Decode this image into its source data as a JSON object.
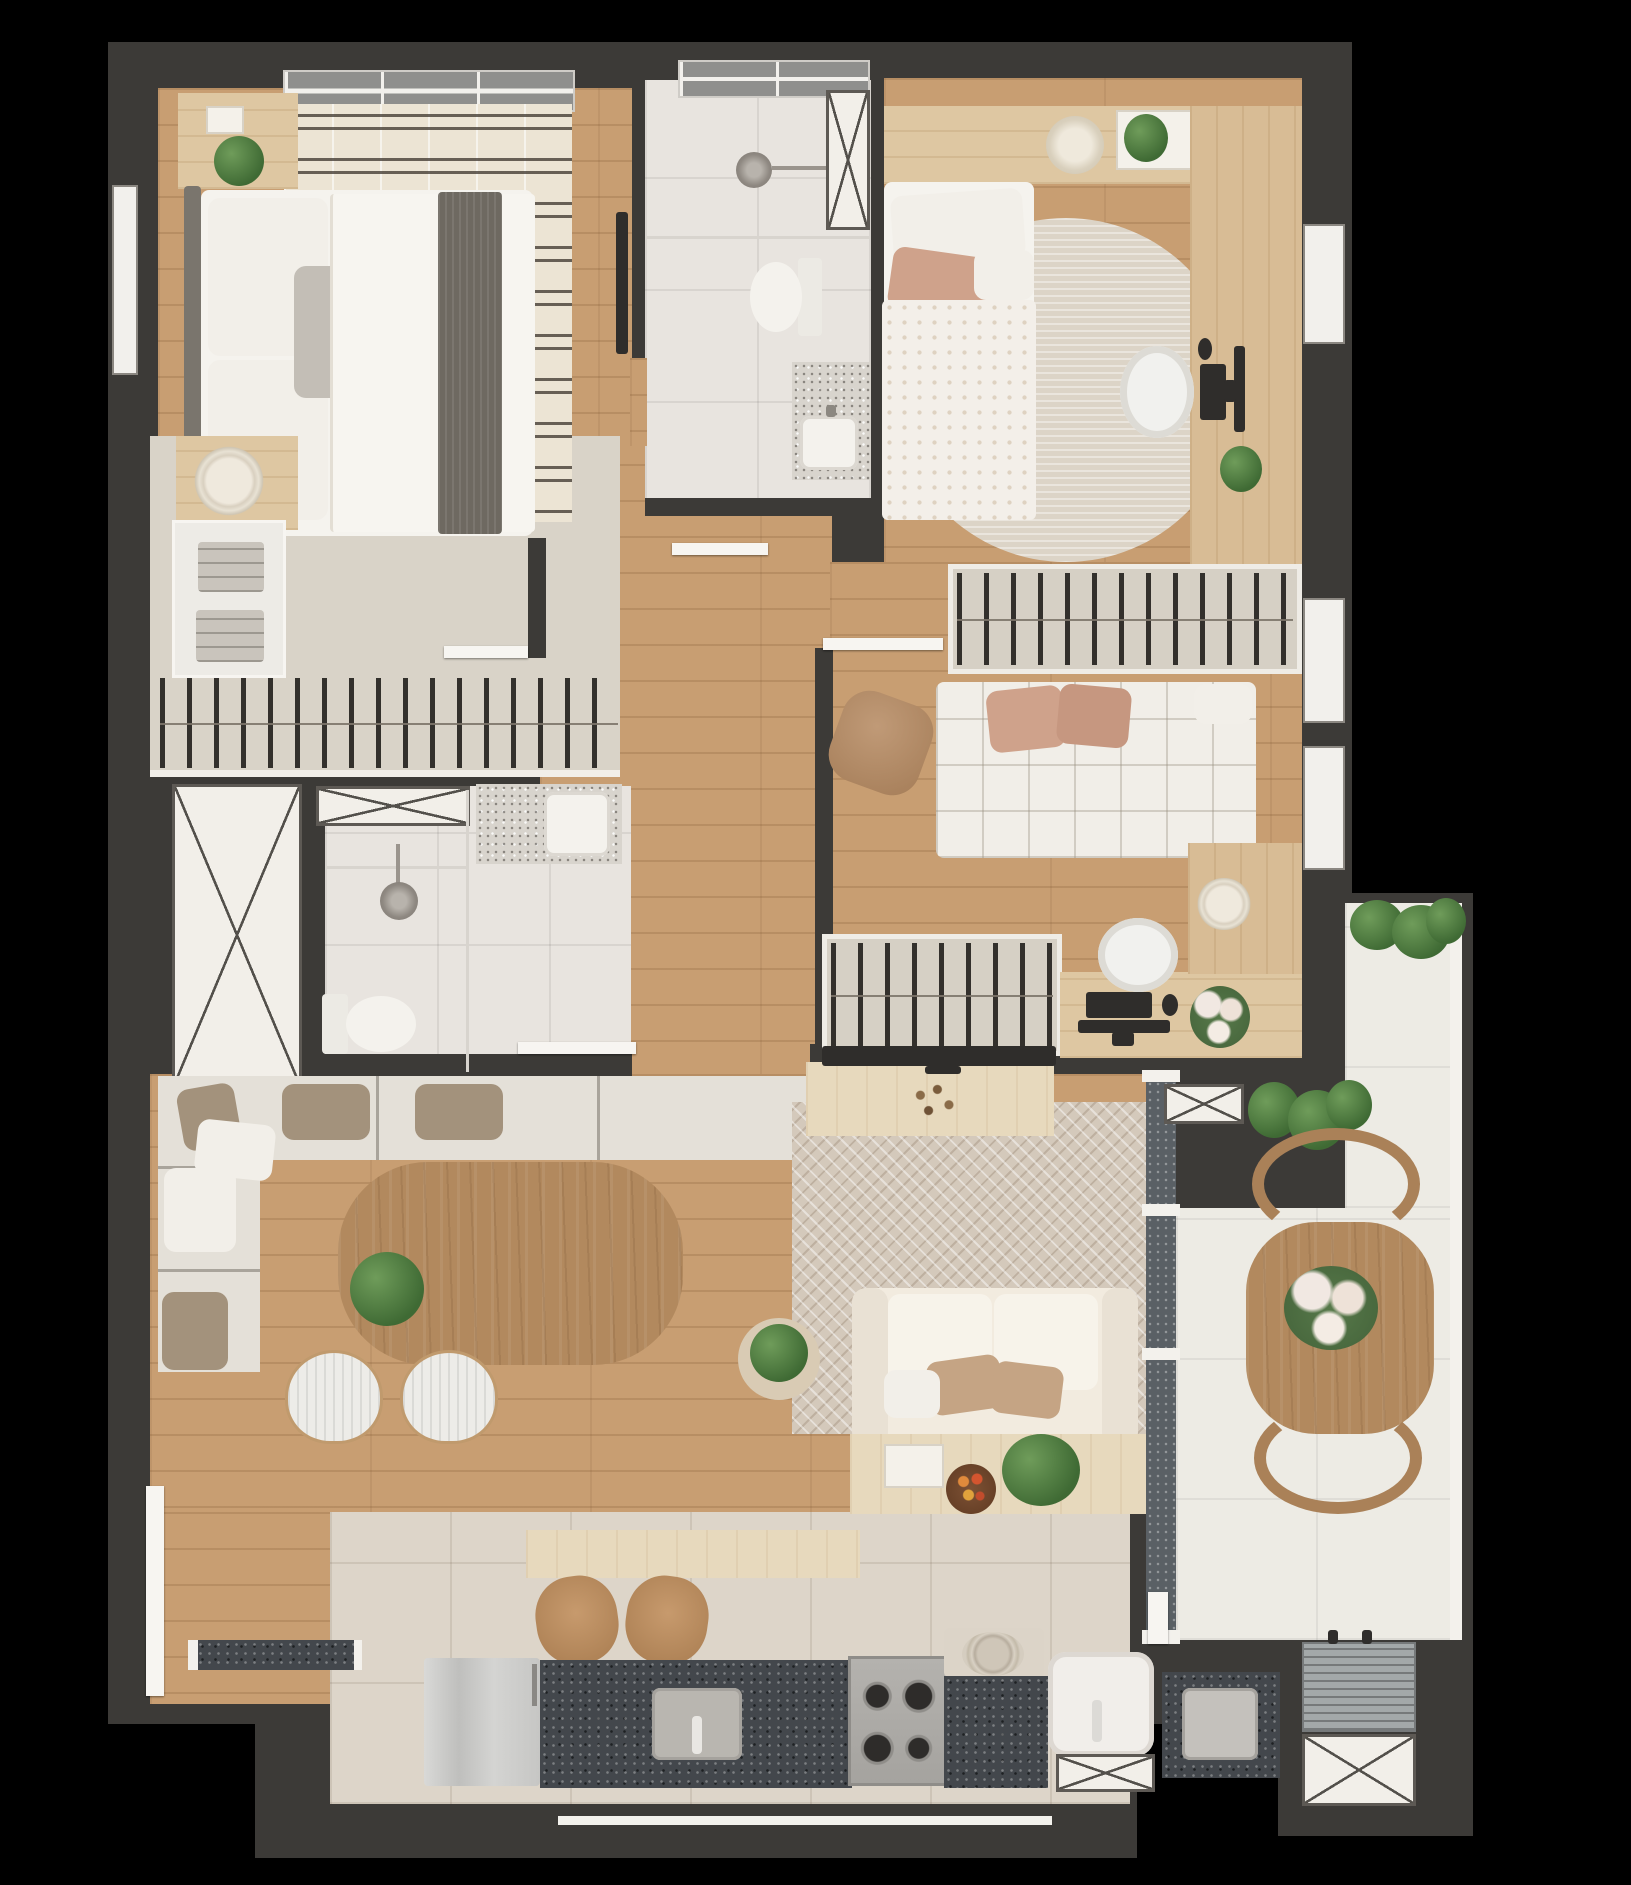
{
  "meta": {
    "type": "apartment-floor-plan",
    "view": "top-down 3d render",
    "background_color": "#000000",
    "visible_text": "none"
  },
  "palette": {
    "wall": "#3c3a37",
    "wood_floor": "#c89e72",
    "closet_floor": "#d9d3c8",
    "bath_tile": "#e8e4df",
    "kitchen_tile": "#ddd5c9",
    "balcony_tile": "#edebe4",
    "granite_dark": "#43474c",
    "granite_light": "#d8d4cd",
    "fixture_white": "#f3f1ec",
    "sofa_cream": "#f2ebdf",
    "furniture_wood": "#dec7a2",
    "table_wood": "#b2895e",
    "pillow_pink": "#cfa28b",
    "pillow_tan": "#c5a484",
    "plant_green": "#4c7340"
  },
  "rooms": [
    {
      "id": "bedroom-1",
      "label": "couple bedroom",
      "furniture": [
        "double-bed",
        "headboard",
        "nightstand-with-plant",
        "nightstand-with-tray",
        "striped-rug",
        "wall-tv",
        "window"
      ]
    },
    {
      "id": "walk-in-closet",
      "label": "walk-in closet",
      "furniture": [
        "hanging-rail-with-hangers",
        "shelf-with-folded-clothes",
        "dresser-with-round-tray"
      ]
    },
    {
      "id": "bathroom-1",
      "label": "suite bathroom",
      "furniture": [
        "shower-head",
        "glass-partition",
        "toilet",
        "granite-vanity-with-sink"
      ]
    },
    {
      "id": "bedroom-2",
      "label": "single bedroom",
      "furniture": [
        "single-bed",
        "headboard-shelf",
        "table-lamp",
        "plant-tray",
        "round-rug",
        "desk-wardrobe-panel",
        "office-chair",
        "keyboard",
        "monitor",
        "mouse",
        "desk-plant"
      ]
    },
    {
      "id": "bedroom-3",
      "label": "guest bedroom / office",
      "furniture": [
        "sofa-bed-with-pillows",
        "pouf",
        "wardrobe-with-hangers-top",
        "wardrobe-with-hangers-bottom",
        "l-shaped-desk",
        "office-chair",
        "keyboard",
        "monitor",
        "mouse",
        "flower-vase",
        "decor-bowl"
      ]
    },
    {
      "id": "bathroom-2",
      "label": "social bathroom",
      "furniture": [
        "shower-head",
        "glass-partition",
        "toilet",
        "granite-vanity-with-sink"
      ]
    },
    {
      "id": "living-dining",
      "label": "living / dining room",
      "furniture": [
        "l-shaped-bench-sofa",
        "throw-pillows",
        "dining-table",
        "table-plant",
        "dining-chair-x2",
        "tv-console",
        "tv",
        "herringbone-rug",
        "two-seat-sofa",
        "side-table-with-plant",
        "back-console-with-tray-fruit-plant",
        "bar-counter",
        "stool-x2",
        "sliding-door"
      ]
    },
    {
      "id": "kitchen",
      "label": "kitchen",
      "furniture": [
        "refrigerator",
        "granite-counter",
        "kitchen-sink",
        "gas-stove-4-burners",
        "bar-stools"
      ]
    },
    {
      "id": "laundry",
      "label": "service / laundry",
      "furniture": [
        "top-load-washer",
        "laundry-tub",
        "granite-counter-with-steel-sink"
      ]
    },
    {
      "id": "balcony",
      "label": "balcony",
      "furniture": [
        "dining-table",
        "curved-chair-x2",
        "flower-centerpiece",
        "vertical-garden",
        "hedge-plants",
        "sliding-glass-door"
      ]
    },
    {
      "id": "service-area",
      "label": "a/c condenser niche",
      "furniture": [
        "condenser-unit"
      ]
    }
  ],
  "plan_symbols": {
    "shafts_marked_x": 6,
    "swing_doors": 5,
    "windows": 6,
    "sliding_doors": 2
  }
}
